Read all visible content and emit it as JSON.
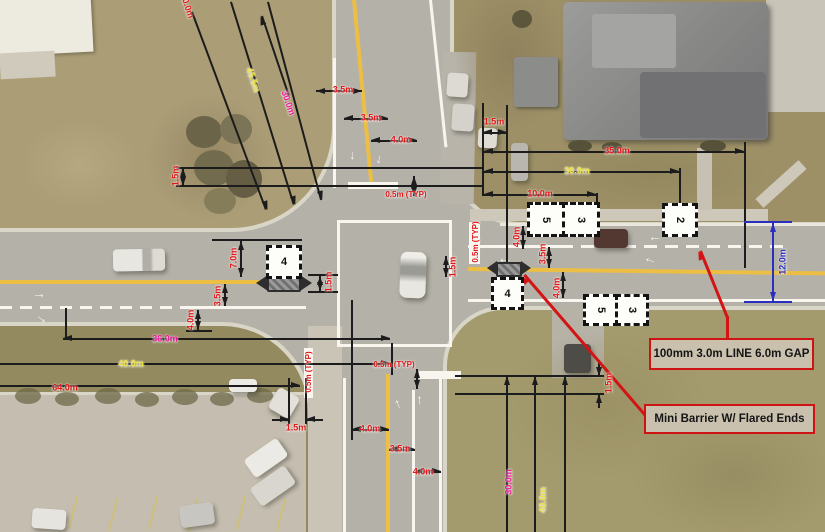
{
  "plan": {
    "type": "pavement-marking-plan",
    "description_visible_text_only": true
  },
  "callouts": {
    "line_spec": {
      "label": "100mm 3.0m LINE 6.0m GAP"
    },
    "mini_barrier": {
      "label": "Mini Barrier W/ Flared Ends"
    }
  },
  "markers": [
    {
      "name": "west-approach-box",
      "label": "4"
    },
    {
      "name": "east-approach-box",
      "label": "4"
    },
    {
      "name": "north-side-pair-left",
      "label": "5"
    },
    {
      "name": "north-side-pair-right",
      "label": "3"
    },
    {
      "name": "south-side-pair-left",
      "label": "5"
    },
    {
      "name": "south-side-pair-right",
      "label": "3"
    },
    {
      "name": "north-side-single",
      "label": "2"
    }
  ],
  "dims": [
    {
      "name": "nw-diagonal-outer",
      "label": "30.0m",
      "color": "red"
    },
    {
      "name": "nw-diagonal-middle",
      "label": "45.5m",
      "color": "yellow"
    },
    {
      "name": "nw-diagonal-inner",
      "label": "30.0m",
      "color": "magenta"
    },
    {
      "name": "nw-boulevard-offset",
      "label": "1.5m",
      "color": "red"
    },
    {
      "name": "north-lane-west",
      "label": "3.5m",
      "color": "red"
    },
    {
      "name": "north-lane-middle",
      "label": "3.5m",
      "color": "red"
    },
    {
      "name": "north-lane-east",
      "label": "4.0m",
      "color": "red"
    },
    {
      "name": "north-stopbar-offset",
      "label": "0.5m (TYP)",
      "color": "red"
    },
    {
      "name": "ne-sidewalk-width",
      "label": "1.5m",
      "color": "red"
    },
    {
      "name": "ne-length-35",
      "label": "35.0m",
      "color": "red"
    },
    {
      "name": "ne-length-30",
      "label": "30.0m",
      "color": "yellow"
    },
    {
      "name": "ne-length-10",
      "label": "10.0m",
      "color": "red"
    },
    {
      "name": "ne-taper-depth",
      "label": "12.0m",
      "color": "blue"
    },
    {
      "name": "ne-channel-line-width",
      "label": "0.5m (TYP)",
      "color": "red"
    },
    {
      "name": "east-median-offset",
      "label": "1.5m",
      "color": "red"
    },
    {
      "name": "east-lane-north",
      "label": "4.0m",
      "color": "red"
    },
    {
      "name": "east-lane-middle",
      "label": "3.5m",
      "color": "red"
    },
    {
      "name": "east-lane-south",
      "label": "4.0m",
      "color": "red"
    },
    {
      "name": "west-barrier-setback",
      "label": "7.0m",
      "color": "red"
    },
    {
      "name": "west-lane-middle",
      "label": "3.5m",
      "color": "red"
    },
    {
      "name": "west-lane-south",
      "label": "4.0m",
      "color": "red"
    },
    {
      "name": "west-barrier-width",
      "label": "1.5m",
      "color": "red"
    },
    {
      "name": "west-length-36",
      "label": "36.0m",
      "color": "magenta"
    },
    {
      "name": "west-length-40",
      "label": "40.0m",
      "color": "yellow"
    },
    {
      "name": "west-length-64",
      "label": "64.0m",
      "color": "red"
    },
    {
      "name": "sw-sidewalk-width",
      "label": "1.5m",
      "color": "red"
    },
    {
      "name": "south-stopbar-offset",
      "label": "0.5m (TYP)",
      "color": "red"
    },
    {
      "name": "south-lane-west",
      "label": "4.0m",
      "color": "red"
    },
    {
      "name": "south-lane-middle",
      "label": "3.5m",
      "color": "red"
    },
    {
      "name": "south-lane-east",
      "label": "4.0m",
      "color": "red"
    },
    {
      "name": "se-sidewalk-width",
      "label": "1.5m",
      "color": "red"
    },
    {
      "name": "se-length-30",
      "label": "30.0m",
      "color": "magenta"
    },
    {
      "name": "se-length-40",
      "label": "40.0m",
      "color": "yellow"
    },
    {
      "name": "south-edge-line-width",
      "label": "0.5m (TYP)",
      "color": "red"
    }
  ],
  "colors": {
    "annotation_red": "#e11818",
    "annotation_yellow": "#ede23e",
    "annotation_magenta": "#f0189a",
    "annotation_blue": "#2b2fbe",
    "leader_red": "#d31414",
    "dimension_black": "#1c1c1c",
    "road_yellow_line": "#ecbe44",
    "marking_white": "#f7f5ee",
    "callout_background": "#c9c1ad",
    "callout_border": "#cf1212"
  }
}
